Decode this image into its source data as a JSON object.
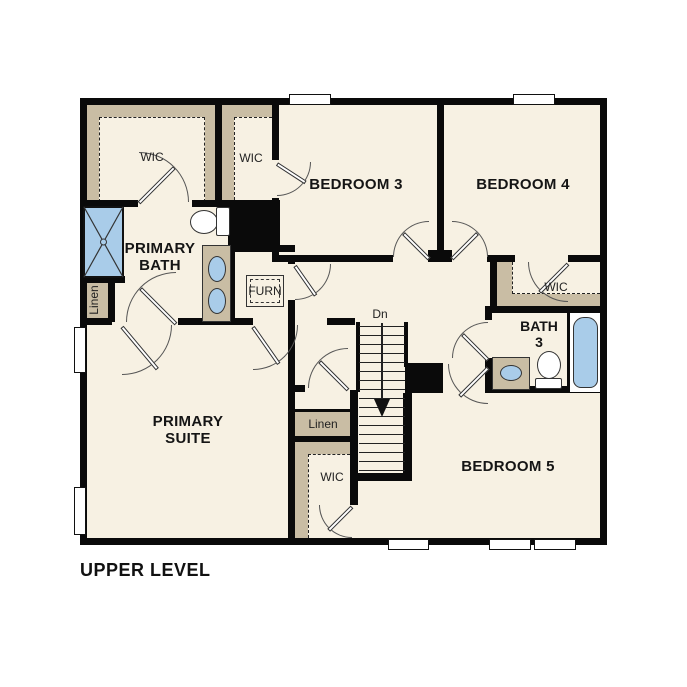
{
  "title": "UPPER LEVEL",
  "colors": {
    "floor": "#f7f1e3",
    "closet": "#c9bda4",
    "fixture": "#a9cce9",
    "wall": "#0a0a0a"
  },
  "rooms": {
    "bedroom3": {
      "label": "BEDROOM 3"
    },
    "bedroom4": {
      "label": "BEDROOM 4"
    },
    "bedroom5": {
      "label": "BEDROOM 5"
    },
    "primary_suite": {
      "label": "PRIMARY SUITE"
    },
    "primary_bath": {
      "label": "PRIMARY BATH"
    },
    "bath3": {
      "label": "BATH 3"
    },
    "wic_primary": {
      "label": "WIC"
    },
    "wic_bedroom3": {
      "label": "WIC"
    },
    "wic_bedroom4": {
      "label": "WIC"
    },
    "wic_bedroom5": {
      "label": "WIC"
    },
    "linen_hall": {
      "label": "Linen"
    },
    "linen_primary": {
      "label": "Linen"
    },
    "furnace": {
      "label": "FURN"
    },
    "stairs": {
      "label": "Dn"
    }
  }
}
